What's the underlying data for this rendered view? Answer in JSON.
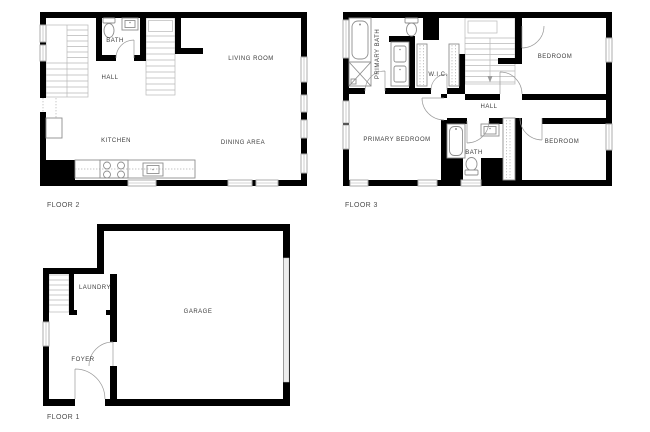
{
  "canvas": {
    "width": 650,
    "height": 432,
    "background": "#ffffff"
  },
  "floors": [
    {
      "label": "FLOOR 2",
      "rooms": {
        "bath": "BATH",
        "hall": "HALL",
        "living_room": "LIVING ROOM",
        "kitchen": "KITCHEN",
        "dining_area": "DINING AREA"
      }
    },
    {
      "label": "FLOOR 3",
      "rooms": {
        "primary_bath": "PRIMARY BATH",
        "wic": "W.I.C.",
        "bedroom_top": "BEDROOM",
        "hall": "HALL",
        "primary_bedroom": "PRIMARY BEDROOM",
        "bath": "BATH",
        "bedroom_bottom": "BEDROOM"
      }
    },
    {
      "label": "FLOOR 1",
      "rooms": {
        "laundry": "LAUNDRY",
        "garage": "GARAGE",
        "foyer": "FOYER"
      }
    }
  ],
  "colors": {
    "wall": "#000000",
    "window_stroke": "#adadad",
    "stair_stroke": "#b8b8b8",
    "fixture_stroke": "#8f8f8f",
    "door_arc": "#9a9a9a",
    "room_label": "#3d3d3d",
    "floor_label": "#4c4c4c"
  }
}
